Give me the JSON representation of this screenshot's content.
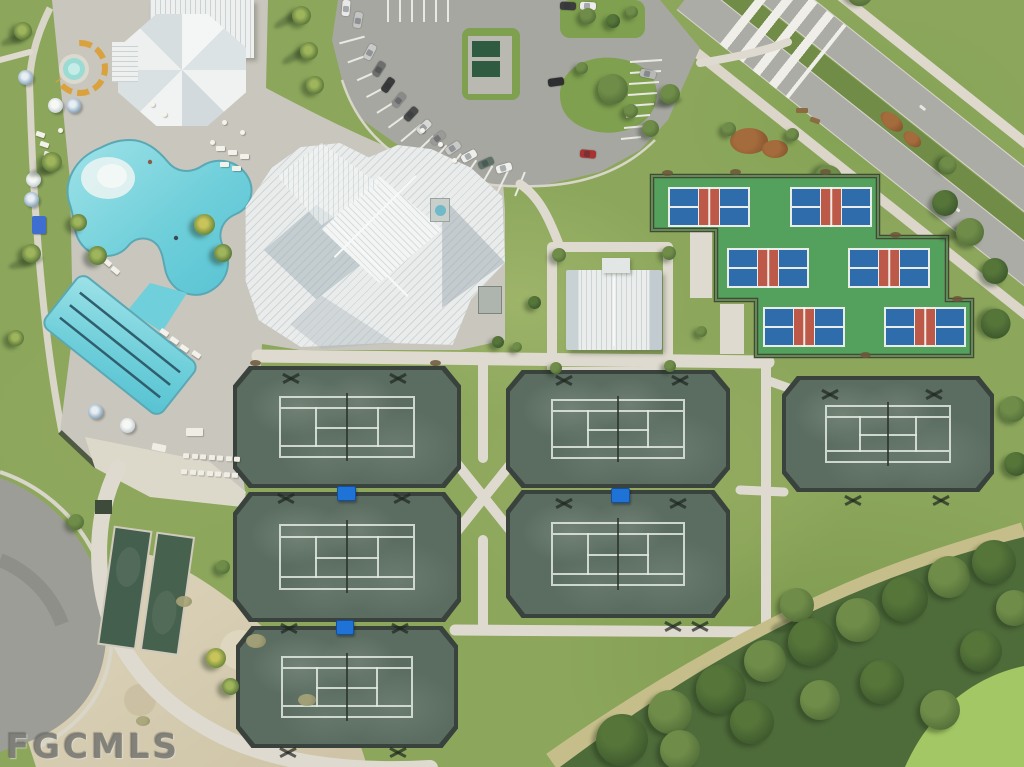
{
  "meta": {
    "type": "aerial-photograph",
    "subject": "Aerial view of a community amenity campus: clubhouse, resort pool, lap pool, spa, tennis courts, pickleball courts, bocce courts, parking lot and entry boulevard",
    "width_px": 1024,
    "height_px": 767
  },
  "watermark": {
    "text": "FGCMLS"
  },
  "scene": {
    "labels": {
      "clubhouse": "Main clubhouse",
      "pool_house": "Poolside pavilion",
      "rec_pavilion": "Courts pavilion",
      "resort_pool": "Free-form resort pool",
      "lap_pool": "Lap pool with 3 lane lines",
      "spa": "Round spa",
      "tennis": "Tennis courts (6)",
      "pickleball": "Pickleball courts (6)",
      "bocce": "Bocce courts (2)",
      "parking": "Parking lot",
      "boulevard": "Entry boulevard with landscaped median and crosswalk",
      "preserve": "Wooded preserve",
      "walkways": "Paved walkway network",
      "pool_deck": "Paver pool deck"
    },
    "counts": {
      "tennis_courts": 6,
      "pickleball_courts": 6,
      "bocce_courts": 2,
      "pools": 2,
      "spas": 1,
      "parked_cars": 18,
      "shade_cabanas": 3
    },
    "palette": {
      "grass": "#8CA75C",
      "deck_pavers": "#C9C6BD",
      "concrete_path": "#DEDACE",
      "asphalt": "#A7A7A2",
      "pool_water": "#6FCFDA",
      "lap_lane_line": "#2F5F6E",
      "roof_white": "#EDF0EF",
      "roof_shadow": "#C6CFD3",
      "pickleball_green": "#53A15C",
      "pickleball_blue": "#2E6CAB",
      "pickleball_red": "#BC5948",
      "tennis_surface": "#5B6C61",
      "tennis_line": "#DDE6DC",
      "cabana_blue": "#1F72D6",
      "preserve_tree": "#4E6B3A",
      "sand": "#D8CFB6",
      "watermark_gray": "#85857F"
    }
  }
}
